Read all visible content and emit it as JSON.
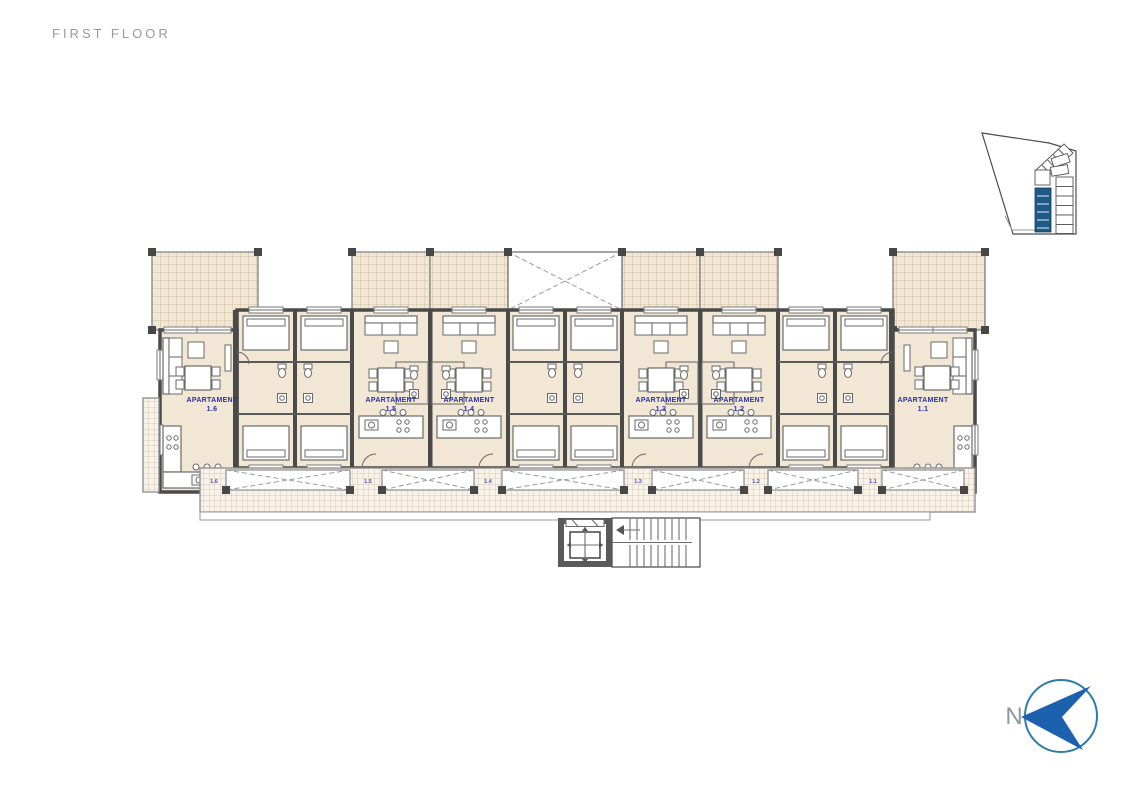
{
  "page": {
    "title": "FIRST FLOOR"
  },
  "plan": {
    "label_prefix": "APARTAMENT",
    "apartments": [
      {
        "number": "1.6"
      },
      {
        "number": "1.5"
      },
      {
        "number": "1.4"
      },
      {
        "number": "1.3"
      },
      {
        "number": "1.2"
      },
      {
        "number": "1.1"
      }
    ]
  },
  "north": {
    "label": "N"
  },
  "colors": {
    "title_gray": "#9b9b9b",
    "room_fill": "#f2e6d4",
    "wall": "#4a4a4a",
    "partition": "#5a5a5a",
    "hatch_line": "#c9b49a",
    "walkway_hatch_line": "#cdbda6",
    "furniture_stroke": "#6a6a6a",
    "apartment_label": "#2832a8",
    "walkway_label": "#4a55b5",
    "site_highlight": "#1d5a86",
    "north_arrow": "#1b61ae",
    "north_circle": "#2e7ca8",
    "north_letter": "#8b98a0"
  }
}
